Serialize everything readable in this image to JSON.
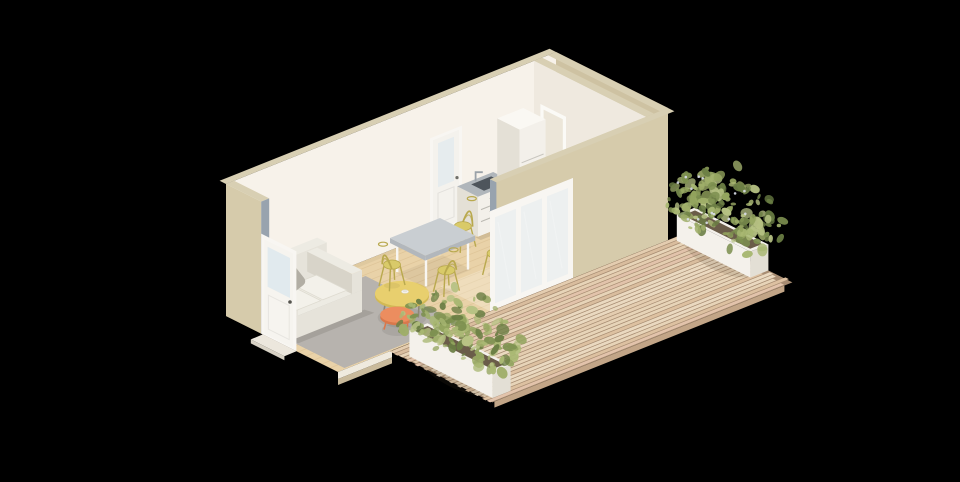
{
  "app": {
    "type": "3d-architectural-render",
    "description": "Isometric cutaway rendering of a compact studio dwelling with open living, dining and kitchenette area, a separate room, a glazed entry door, sliding glass doors and a timber deck with two white planter boxes of green shrubs",
    "background": "#000000"
  },
  "canvas": {
    "width": 960,
    "height": 482
  },
  "scene": {
    "building": {
      "rooms": [
        {
          "name": "living-kitchen-dining"
        },
        {
          "name": "separate-room"
        }
      ],
      "doors": [
        {
          "name": "entry-door",
          "type": "glazed single door",
          "color": "#f6f4ef"
        },
        {
          "name": "back-door",
          "type": "single door with glazing",
          "color": "#f4f2ed"
        },
        {
          "name": "partition-door",
          "type": "interior doorway",
          "color": "#fbfaf6"
        },
        {
          "name": "sliding-glass-door",
          "panels": 3,
          "frame_color": "#f8f6f2"
        }
      ]
    },
    "furniture": [
      {
        "name": "sofa",
        "color": "#e6e3da",
        "pillows": 2
      },
      {
        "name": "coffee-table-round",
        "color": "#e8cf6e",
        "item_on_top": "white cup"
      },
      {
        "name": "nesting-side-table",
        "color": "#ec8d5f"
      },
      {
        "name": "dining-table",
        "top_color": "#c9ced2",
        "legs": "white"
      },
      {
        "name": "dining-chairs",
        "count": 4,
        "color": "#d9ca69"
      },
      {
        "name": "kitchen-counter",
        "features": [
          "stainless sink",
          "faucet",
          "drawers"
        ]
      },
      {
        "name": "refrigerator-cabinet",
        "color": "#f3f0ea"
      },
      {
        "name": "area-rug",
        "color": "#b7b3ae"
      }
    ],
    "outdoor": {
      "deck": {
        "material": "timber planks",
        "plank_count": 24
      },
      "planters": [
        {
          "name": "planter-left",
          "box_color": "#f4f1eb",
          "plant": "green shrub"
        },
        {
          "name": "planter-right",
          "box_color": "#f4f1eb",
          "plant": "green shrub with pale flowers"
        }
      ]
    },
    "palette": {
      "background": "#000000",
      "wall_beige": "#d6cbab",
      "wall_beige_dark": "#cec2a2",
      "wall_strip": "#d8cfb3",
      "interior_white": "#f7f2ea",
      "interior_shade": "#efe9df",
      "floor_wood": "#e9d2a8",
      "floor_line": "#c9a877",
      "right_room_floor": "#f0eadd",
      "rug_gray": "#b7b3ae",
      "sofa_top": "#edebe3",
      "sofa_front": "#e6e3da",
      "sofa_side": "#d8d4c9",
      "sofa_cushion": "#f3f1ea",
      "pillow_light": "#cac6bd",
      "pillow_dark": "#b2aea4",
      "table_yellow": "#e8cf6e",
      "table_yellow_side": "#d2b955",
      "table_orange": "#ec8d5f",
      "table_orange_dark": "#d9784c",
      "leg_gray": "#8f8778",
      "dining_top": "#c9ced2",
      "dining_side": "#b2b7bc",
      "white_trim": "#f8f6f2",
      "chair_yellow": "#d9ca69",
      "chair_outline": "#b9a94e",
      "counter_top": "#b0b6bb",
      "sink_dark": "#4e555c",
      "steel": "#9aa1a8",
      "unit_cream": "#f3f0ea",
      "unit_shade": "#e4e0d6",
      "unit_top": "#faf8f3",
      "glass_tint": "#dfe9ed",
      "cut_cap": "#98a3ae",
      "deck_base": "#a78c72",
      "deck_planks": [
        "#e7d4b8",
        "#ddc1a1",
        "#e2c3ab",
        "#ead9c0",
        "#d9bd9e",
        "#e4cdb0"
      ],
      "deck_edge": "#c2a587",
      "planter_white": "#f4f1eb",
      "planter_shade": "#e3dfd5",
      "soil": "#6a5c49",
      "leaf_greens": [
        "#93a45e",
        "#a9b873",
        "#7d9050",
        "#b7c284",
        "#6b7e44",
        "#9fae69"
      ],
      "flower": "#d9dee9",
      "shadow": "rgba(40,32,22,0.12)"
    }
  }
}
